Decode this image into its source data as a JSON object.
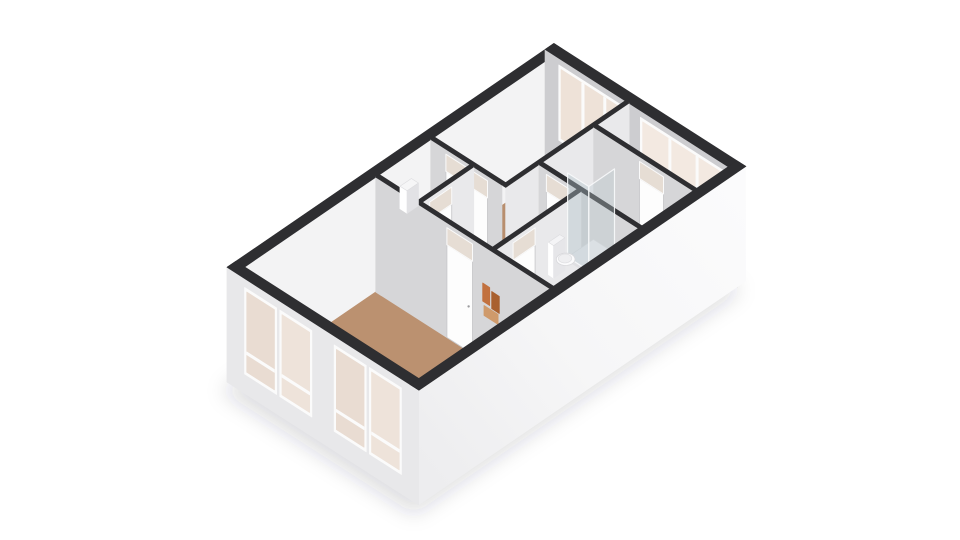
{
  "view": {
    "title": "3d-floorplan-isometric-view",
    "canvas_width": 960,
    "canvas_height": 540
  },
  "palette": {
    "background": "#ffffff",
    "wall_top": "#2e2e31",
    "wall_face_sw": "#d6d6d8",
    "wall_face_se": "#e9e9eb",
    "exterior_inner_nw": "#f3f3f4",
    "exterior_inner_ne": "#cdcdd0",
    "exterior_outer_sw": "#e8e8ea",
    "floor_wood": "#bb9170",
    "floor_gray": "#d7d7d9",
    "window_glass": "#ecdfd5",
    "door_leaf": "#fdfdfd",
    "transom_glass": "#e6ddd4",
    "art_orange": "#c2713f"
  },
  "scene": {
    "origin": [
      227,
      382
    ],
    "u_per_m": [
      31.43,
      -21.52
    ],
    "v_per_m": [
      32,
      20.5
    ],
    "z_px_per_m": 45,
    "wall_height": 2.55,
    "door_height": 2.06,
    "render": [
      {
        "kind": "shadow",
        "name": "ground-shadow",
        "pts": [
          [
            0,
            0
          ],
          [
            10.4,
            0
          ],
          [
            10.4,
            6
          ],
          [
            0,
            6
          ]
        ],
        "dx": -5,
        "dy": 9,
        "blur": 11,
        "fill": "rgba(50,50,55,0.16)"
      },
      {
        "kind": "wall",
        "name": "exterior-wall-n-nw",
        "axis": "y",
        "at": 0.28,
        "t": 0.28,
        "from": 0,
        "to": 10.4,
        "face": "#f3f3f4",
        "top": "#2e2e31"
      },
      {
        "kind": "wall",
        "name": "exterior-wall-ne",
        "axis": "x",
        "at": 10.12,
        "t": 0.28,
        "from": 0,
        "to": 6,
        "face": "#cdcdd0",
        "top": "#2e2e31",
        "windows": [
          {
            "a1": 0.5,
            "a2": 2.55,
            "z1": 0.8,
            "z2": 2.33,
            "mullions": 3,
            "glass": "#eee2d8"
          },
          {
            "a1": 3.05,
            "a2": 5.6,
            "z1": 1.5,
            "z2": 2.33,
            "mullions": 3,
            "glass": "#f3e9e1"
          }
        ]
      },
      {
        "kind": "floor",
        "name": "floor-living-room",
        "pts": [
          [
            0.28,
            0.28
          ],
          [
            4.45,
            0.28
          ],
          [
            4.45,
            5.72
          ],
          [
            0.28,
            5.72
          ]
        ],
        "fill": "#bb9170"
      },
      {
        "kind": "floor",
        "name": "floor-wc",
        "pts": [
          [
            4.57,
            0.28
          ],
          [
            6.2,
            0.28
          ],
          [
            6.2,
            1.5
          ],
          [
            4.57,
            1.5
          ]
        ],
        "fill": "#dadadb"
      },
      {
        "kind": "floor",
        "name": "floor-hall",
        "pts": [
          [
            4.57,
            1.62
          ],
          [
            6.2,
            1.62
          ],
          [
            6.2,
            2.62
          ],
          [
            7.26,
            2.62
          ],
          [
            7.26,
            3.81
          ],
          [
            4.57,
            3.81
          ]
        ],
        "fill": "#dadadb"
      },
      {
        "kind": "floor",
        "name": "floor-bedroom-1",
        "pts": [
          [
            6.32,
            0.28
          ],
          [
            10.12,
            0.28
          ],
          [
            10.12,
            2.5
          ],
          [
            6.32,
            2.5
          ]
        ],
        "fill": "#b88e6e"
      },
      {
        "kind": "floor",
        "name": "floor-bathroom",
        "pts": [
          [
            7.38,
            2.62
          ],
          [
            9.0,
            2.62
          ],
          [
            9.0,
            5.72
          ],
          [
            7.38,
            5.72
          ]
        ],
        "fill": "#d7d7d9"
      },
      {
        "kind": "floor",
        "name": "floor-bedroom-2",
        "pts": [
          [
            4.57,
            3.93
          ],
          [
            7.26,
            3.93
          ],
          [
            7.26,
            5.72
          ],
          [
            4.57,
            5.72
          ]
        ],
        "fill": "#d2d2d4"
      },
      {
        "kind": "floor",
        "name": "floor-east-room",
        "pts": [
          [
            9.12,
            2.62
          ],
          [
            10.12,
            2.62
          ],
          [
            10.12,
            5.72
          ],
          [
            9.12,
            5.72
          ]
        ],
        "fill": "#b88e6e"
      },
      {
        "kind": "wall",
        "name": "wall-bedroom1-south",
        "axis": "y",
        "at": 2.62,
        "t": 0.12,
        "from": 6.2,
        "to": 10.12,
        "face": "#e9e9eb",
        "top": "#2e2e31"
      },
      {
        "kind": "wall",
        "name": "wall-bathroom-east",
        "axis": "x",
        "at": 9.0,
        "t": 0.12,
        "from": 2.62,
        "to": 5.72,
        "face": "#d6d6d8",
        "top": "#2e2e31",
        "doors": [
          {
            "a1": 4.05,
            "a2": 4.8,
            "transom": true
          }
        ]
      },
      {
        "kind": "wall",
        "name": "wall-bedroom1-west",
        "axis": "x",
        "at": 6.2,
        "t": 0.12,
        "from": 0.28,
        "to": 2.5,
        "face": "#d6d6d8",
        "top": "#2e2e31",
        "doors": [
          {
            "a1": 0.75,
            "a2": 2.05,
            "double": true,
            "transom": true
          }
        ]
      },
      {
        "kind": "wall",
        "name": "wall-bathroom-west",
        "axis": "x",
        "at": 7.26,
        "t": 0.12,
        "from": 2.62,
        "to": 5.72,
        "face": "#d6d6d8",
        "top": "#2e2e31",
        "doors": [
          {
            "a1": 2.85,
            "a2": 3.55,
            "transom": true
          }
        ]
      },
      {
        "kind": "wall",
        "name": "wall-wc-south",
        "axis": "y",
        "at": 1.62,
        "t": 0.12,
        "from": 4.57,
        "to": 6.2,
        "face": "#e9e9eb",
        "top": "#2e2e31",
        "doors": [
          {
            "a1": 4.8,
            "a2": 5.5,
            "transom": true
          }
        ]
      },
      {
        "kind": "wall",
        "name": "wall-bedroom2-north",
        "axis": "y",
        "at": 3.93,
        "t": 0.12,
        "from": 4.57,
        "to": 7.26,
        "face": "#e9e9eb",
        "top": "#2e2e31",
        "doors": [
          {
            "a1": 5.1,
            "a2": 5.8,
            "transom": true
          }
        ]
      },
      {
        "kind": "wall",
        "name": "wall-living-east",
        "axis": "x",
        "at": 4.45,
        "t": 0.12,
        "from": 0.28,
        "to": 5.72,
        "face": "#d6d6d8",
        "top": "#2e2e31",
        "doors": [
          {
            "a1": 2.5,
            "a2": 3.3,
            "transom": true
          }
        ],
        "decals": [
          {
            "a1": 3.62,
            "a2": 3.84,
            "z1": 1.32,
            "z2": 1.72,
            "fill": "#c2713f"
          },
          {
            "a1": 3.9,
            "a2": 4.14,
            "z1": 1.28,
            "z2": 1.66,
            "fill": "#a9602f"
          },
          {
            "a1": 3.66,
            "a2": 4.1,
            "z1": 1.02,
            "z2": 1.24,
            "fill": "#cf9a6b"
          }
        ]
      },
      {
        "kind": "box",
        "name": "wc-wall-cabinet",
        "x1": 5.2,
        "x2": 5.56,
        "y1": 0.3,
        "y2": 0.52,
        "z1": 1.5,
        "z2": 2.0,
        "top": "#f6f6f7",
        "sw": "#ffffff",
        "se": "#e2e2e5"
      },
      {
        "kind": "box",
        "name": "shower-tray",
        "x1": 8.15,
        "x2": 8.97,
        "y1": 2.64,
        "y2": 3.3,
        "z1": 0,
        "z2": 0.08,
        "top": "#ececee",
        "sw": "#e0e0e3",
        "se": "#d6d6d9"
      },
      {
        "kind": "glass",
        "name": "shower-glass-side",
        "axis": "x",
        "at": 8.15,
        "a1": 2.64,
        "a2": 3.3,
        "z1": 0.08,
        "z2": 1.95,
        "fill": "rgba(176,192,200,0.4)",
        "stroke": "rgba(248,250,251,0.9)"
      },
      {
        "kind": "glass",
        "name": "shower-glass-front",
        "axis": "y",
        "at": 3.3,
        "a1": 8.15,
        "a2": 8.97,
        "z1": 0.08,
        "z2": 1.95,
        "fill": "rgba(190,203,210,0.35)",
        "stroke": "rgba(248,250,251,0.9)"
      },
      {
        "kind": "box",
        "name": "toilet-tank",
        "x1": 7.52,
        "x2": 7.88,
        "y1": 2.66,
        "y2": 2.82,
        "z1": 0,
        "z2": 0.72,
        "top": "#f4f4f6",
        "sw": "#ffffff",
        "se": "#e6e6e9"
      },
      {
        "kind": "disc",
        "name": "toilet-bowl",
        "cx": 7.7,
        "cy": 3.02,
        "r": 0.21,
        "z": 0.42,
        "fill": "#fbfbfc",
        "stroke": "#d8d8db"
      },
      {
        "kind": "disc",
        "name": "toilet-seat",
        "cx": 7.7,
        "cy": 3.0,
        "r": 0.15,
        "z": 0.43,
        "fill": "#efeff1",
        "stroke": "#e0e0e3"
      },
      {
        "kind": "wall",
        "name": "exterior-wall-sw",
        "axis": "x",
        "at": 0,
        "t": 0.28,
        "from": 0,
        "to": 6,
        "face": "#e8e8ea",
        "top": "#2e2e31",
        "windows": [
          {
            "a1": 0.62,
            "a2": 1.48,
            "z1": 0.5,
            "z2": 2.28,
            "mullions": 1,
            "crossbar": 0.92,
            "glass": "#e9dcd2"
          },
          {
            "a1": 1.72,
            "a2": 2.58,
            "z1": 0.5,
            "z2": 2.28,
            "mullions": 1,
            "crossbar": 0.92,
            "glass": "#eee3da"
          },
          {
            "a1": 3.42,
            "a2": 4.28,
            "z1": 0.5,
            "z2": 2.28,
            "mullions": 1,
            "crossbar": 0.92,
            "glass": "#e9dcd2"
          },
          {
            "a1": 4.52,
            "a2": 5.38,
            "z1": 0.5,
            "z2": 2.28,
            "mullions": 1,
            "crossbar": 0.92,
            "glass": "#eee3da"
          }
        ]
      },
      {
        "kind": "wall",
        "name": "exterior-wall-se",
        "axis": "y",
        "at": 6,
        "t": 0.28,
        "from": 0,
        "to": 10.4,
        "face": "url(#gradSE)",
        "top": "#2e2e31"
      }
    ]
  }
}
